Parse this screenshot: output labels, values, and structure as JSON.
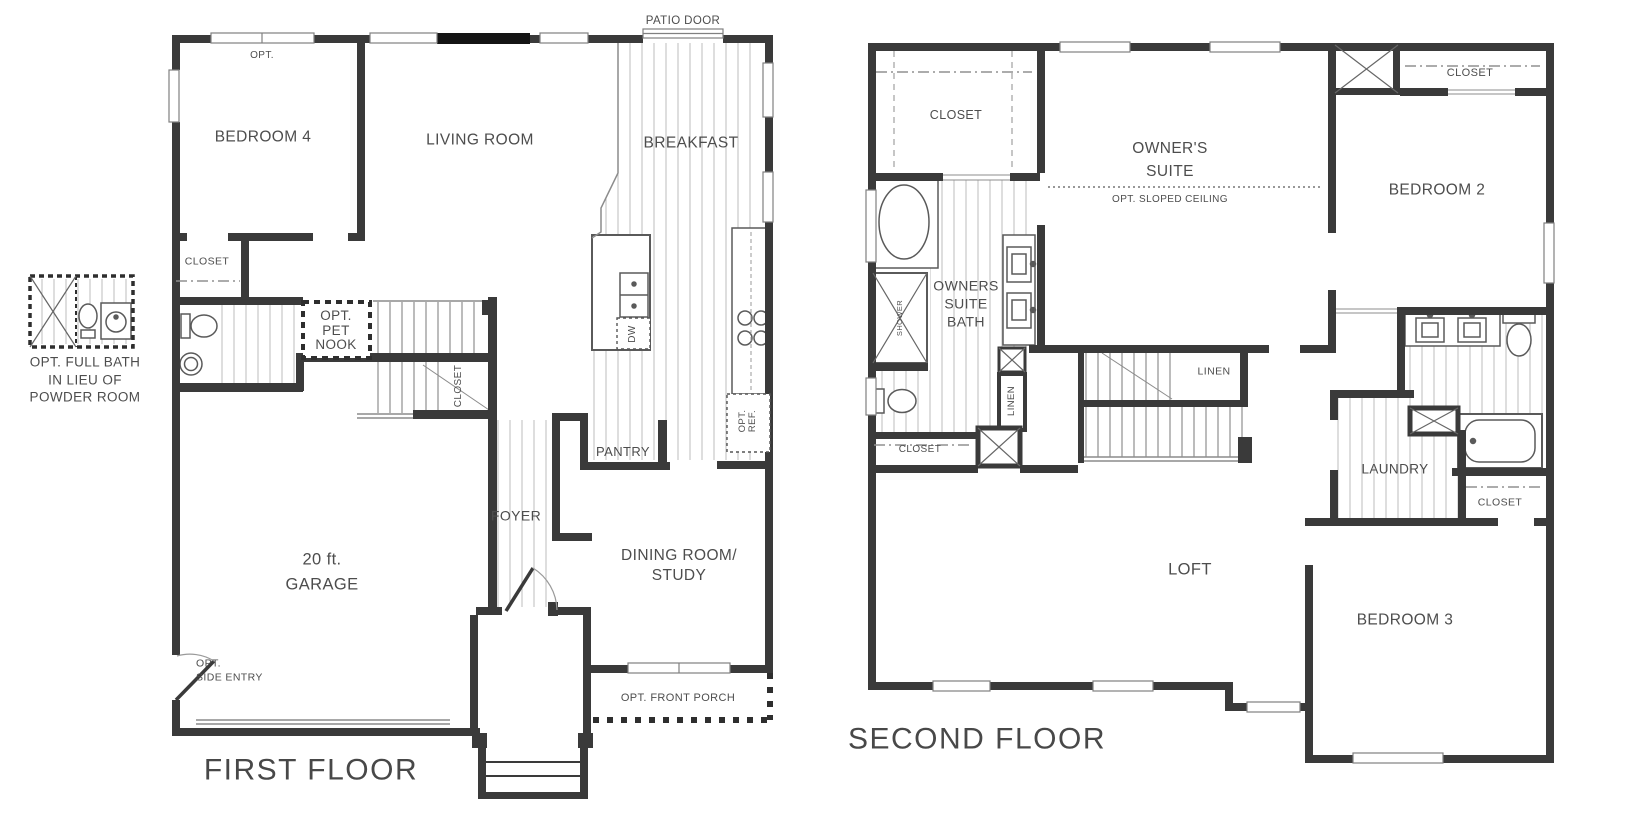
{
  "first_floor": {
    "title": "FIRST FLOOR",
    "rooms": {
      "bedroom4": "BEDROOM 4",
      "living_room": "LIVING ROOM",
      "breakfast": "BREAKFAST",
      "garage": "20 ft.\nGARAGE",
      "foyer": "FOYER",
      "dining_study": "DINING ROOM/\nSTUDY",
      "pantry": "PANTRY",
      "closet_bedroom4": "CLOSET",
      "closet_under_stairs": "CLOSET"
    },
    "annotations": {
      "patio_door": "PATIO DOOR",
      "opt_window": "OPT.",
      "pet_nook": "OPT.\nPET\nNOOK",
      "dishwasher": "DW",
      "opt_fridge": "OPT.\nREF.",
      "side_entry": "OPT.\nSIDE ENTRY",
      "front_porch": "OPT. FRONT PORCH"
    }
  },
  "option_callout": "OPT. FULL BATH\nIN LIEU OF\nPOWDER ROOM",
  "second_floor": {
    "title": "SECOND FLOOR",
    "rooms": {
      "owners_suite": "OWNER'S\nSUITE",
      "owners_suite_bath": "OWNERS\nSUITE\nBATH",
      "bedroom2": "BEDROOM 2",
      "bedroom3": "BEDROOM 3",
      "loft": "LOFT",
      "laundry": "LAUNDRY",
      "closet_owners": "CLOSET",
      "closet_bedroom2": "CLOSET",
      "closet_owners_bath": "CLOSET",
      "closet_hall_bath": "CLOSET",
      "linen_stairs": "LINEN",
      "linen_hall": "LINEN",
      "shower": "SHOWER"
    },
    "annotations": {
      "sloped_ceiling": "OPT. SLOPED CEILING"
    }
  },
  "colors": {
    "wall": "#3a3a3a",
    "text": "#4d4d4d",
    "hatch": "#b6b6b6",
    "background": "#ffffff"
  }
}
